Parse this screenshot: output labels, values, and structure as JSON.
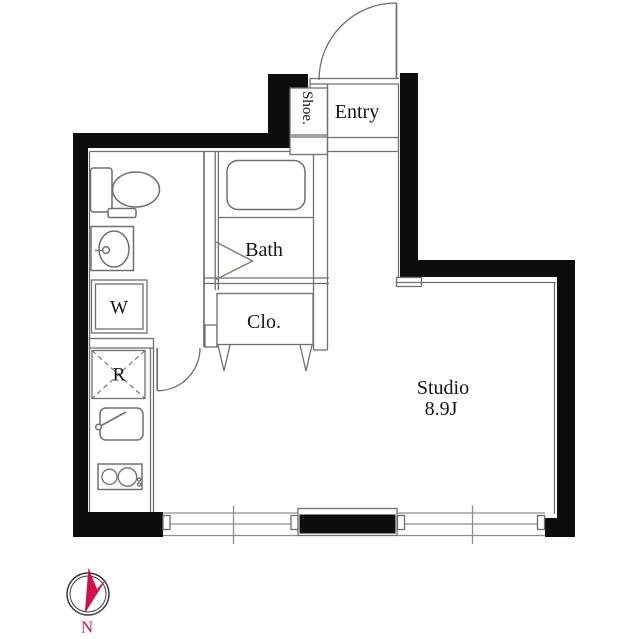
{
  "title": "Studio apartment floor plan",
  "labels": {
    "shoe": "Shoe.",
    "entry": "Entry",
    "bath": "Bath",
    "closet": "Clo.",
    "washer": "W",
    "refrigerator": "R",
    "studio_line1": "Studio",
    "studio_line2": "8.9J",
    "compass_north": "N"
  },
  "colors": {
    "background": "#ffffff",
    "wall": "#0d0d0d",
    "line": "#6f6f6f",
    "line_light": "#8d8d8d",
    "text": "#141414",
    "bath_door": "#8a7b70",
    "compass_red": "#d0114a"
  }
}
